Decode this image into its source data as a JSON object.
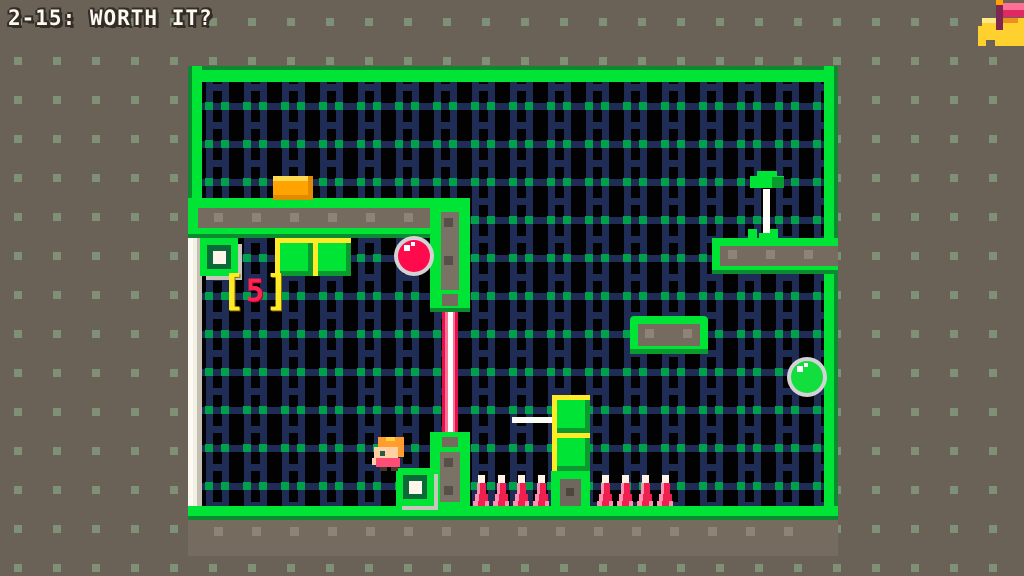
{
  "hud": {
    "title": "2-15: WORTH IT?",
    "level_number": "2-15",
    "level_name": "WORTH IT?",
    "counter": {
      "open": "[",
      "value": "5",
      "close": "]"
    },
    "flag_icon": "goal-flag"
  },
  "level": {
    "entities": {
      "player": 1,
      "switch_buttons": 2,
      "crates": 4,
      "red_ball": 1,
      "green_ball": 1,
      "laser_gate": 1,
      "white_beam": 1,
      "spikes": 8,
      "moving_platform": 1,
      "gold_block": 1,
      "flag_plant": 1,
      "exit_gap_right_wall": 1
    }
  },
  "colors": {
    "background": "#6b6257",
    "background_dot": "#7f9077",
    "wall_green": "#00e436",
    "wall_green_dark": "#0c8a30",
    "wall_gray": "#756c5f",
    "stud_light": "#8d8477",
    "stud_dark": "#57504a",
    "interior_black": "#020202",
    "ladder_navy": "#1f2d56",
    "grid_dot_green": "#00a14b",
    "white_wall": "#f2efe5",
    "silver": "#c8c5bd",
    "red": "#ff0a4d",
    "spike_red": "#ef2050",
    "spike_pink": "#ff8fae",
    "orange": "#ffa300",
    "yellow": "#ffec27",
    "flag_pink": "#ff7097",
    "flag_dark_pink": "#e22862",
    "flag_pole_purple": "#7e2553",
    "mound_yellow": "#ffd12e"
  }
}
